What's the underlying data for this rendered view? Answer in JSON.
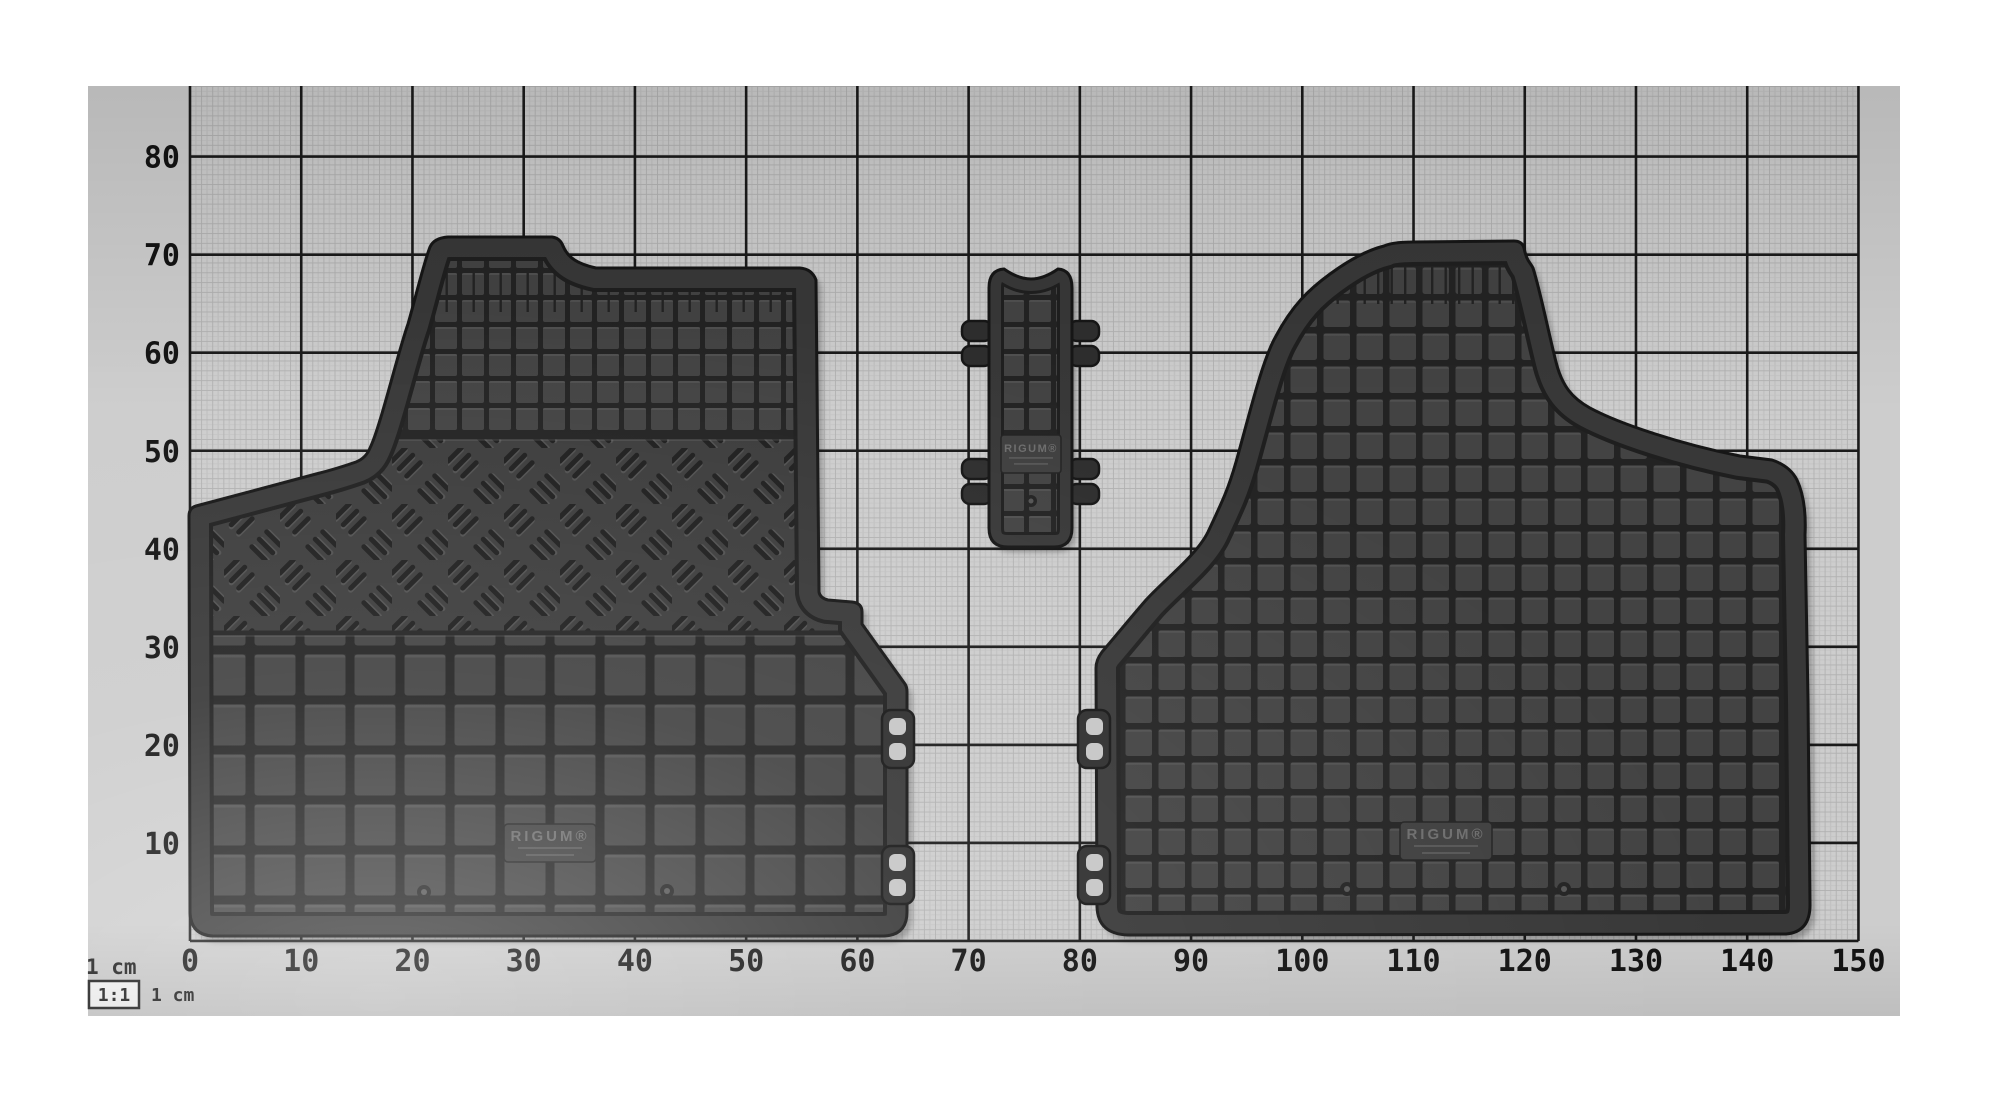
{
  "photo": {
    "description": "Rubber car floor mat set photographed flat on 1:1 centimetre measurement paper",
    "items": [
      "left-front-floor-mat",
      "tunnel-connector-mat",
      "right-front-floor-mat"
    ]
  },
  "ruler": {
    "unit": "cm",
    "x_labels": [
      "0",
      "10",
      "20",
      "30",
      "40",
      "50",
      "60",
      "70",
      "80",
      "90",
      "100",
      "110",
      "120",
      "130",
      "140",
      "150"
    ],
    "y_labels": [
      "10",
      "20",
      "30",
      "40",
      "50",
      "60",
      "70",
      "80"
    ]
  },
  "legend": {
    "unit_label_top": "1 cm",
    "scale_badge": "1:1",
    "unit_label_side": "1 cm"
  },
  "mats": {
    "left_mat": {
      "brand_stamp": "RIGUM®"
    },
    "tunnel_mat": {
      "brand_stamp": "RIGUM®"
    },
    "right_mat": {
      "brand_stamp": "RIGUM®"
    }
  },
  "palette": {
    "paper": "#cdcdcd",
    "grid_minor": "#b1b1b1",
    "grid_mid": "#c2c2c2",
    "grid_major": "#1a1a1a",
    "label": "#131313",
    "mat_base": "#2e2e2e",
    "mat_border": "#383838",
    "mat_edge": "#161616",
    "mat_edge_in": "#1f1f1f",
    "square_face": "#434343",
    "groove": "#232323",
    "tread_base": "#3c3c3c",
    "tread_slash": "#1e1e1e",
    "stamp_bg": "#3f3f3f",
    "stamp_text": "#6d6d6d",
    "stamp_line": "#565656",
    "hook_hole": "#c6c6c6"
  }
}
